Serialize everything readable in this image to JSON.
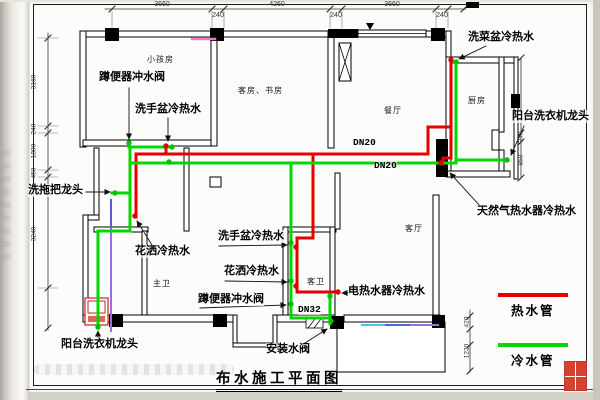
{
  "title": "布水施工平面图",
  "legend": [
    {
      "label": "热水管",
      "color": "#e60000"
    },
    {
      "label": "冷水管",
      "color": "#00d800"
    }
  ],
  "colors": {
    "hot": "#e60000",
    "cold": "#00d800",
    "wall": "#000000"
  },
  "rooms": [
    {
      "label": "小孩房",
      "x": 147,
      "y": 55
    },
    {
      "label": "客房、书房",
      "x": 238,
      "y": 86
    },
    {
      "label": "餐厅",
      "x": 384,
      "y": 106
    },
    {
      "label": "厨房",
      "x": 468,
      "y": 96
    },
    {
      "label": "客厅",
      "x": 405,
      "y": 224
    },
    {
      "label": "主卫",
      "x": 153,
      "y": 279
    },
    {
      "label": "客卫",
      "x": 307,
      "y": 277
    }
  ],
  "fixtures": [
    {
      "label": "蹲便器冲水阀",
      "x": 99,
      "y": 71
    },
    {
      "label": "洗手盆冷热水",
      "x": 135,
      "y": 103
    },
    {
      "label": "洗菜盆冷热水",
      "x": 468,
      "y": 31
    },
    {
      "label": "阳台洗衣机龙头",
      "x": 512,
      "y": 110
    },
    {
      "label": "洗拖把龙头",
      "x": 28,
      "y": 184
    },
    {
      "label": "天然气热水器冷热水",
      "x": 477,
      "y": 205
    },
    {
      "label": "洗手盆冷热水",
      "x": 218,
      "y": 230
    },
    {
      "label": "花洒冷热水",
      "x": 224,
      "y": 265
    },
    {
      "label": "蹲便器冲水阀",
      "x": 198,
      "y": 293
    },
    {
      "label": "电热水器冷热水",
      "x": 348,
      "y": 285
    },
    {
      "label": "花洒冷热水",
      "x": 135,
      "y": 245
    },
    {
      "label": "阳台洗衣机龙头",
      "x": 61,
      "y": 338
    },
    {
      "label": "安装水阀",
      "x": 266,
      "y": 343
    }
  ],
  "pipe_sizes": [
    {
      "label": "DN20",
      "x": 353,
      "y": 138
    },
    {
      "label": "DN20",
      "x": 374,
      "y": 161
    },
    {
      "label": "DN32",
      "x": 298,
      "y": 305
    }
  ],
  "dims_top": [
    {
      "label": "3660",
      "x": 162,
      "y": 1
    },
    {
      "label": "240",
      "x": 218,
      "y": 12
    },
    {
      "label": "4260",
      "x": 277,
      "y": 1
    },
    {
      "label": "240",
      "x": 336,
      "y": 12
    },
    {
      "label": "3660",
      "x": 392,
      "y": 1
    },
    {
      "label": "240",
      "x": 442,
      "y": 12
    }
  ],
  "dims_left": [
    {
      "label": "3160",
      "x": 34,
      "y": 82
    },
    {
      "label": "240",
      "x": 34,
      "y": 129
    },
    {
      "label": "1800",
      "x": 34,
      "y": 151
    },
    {
      "label": "450",
      "x": 34,
      "y": 173
    },
    {
      "label": "3240",
      "x": 34,
      "y": 234
    }
  ],
  "dims_right": [
    {
      "label": "240",
      "x": 521,
      "y": 137
    },
    {
      "label": "850",
      "x": 521,
      "y": 160
    },
    {
      "label": "420",
      "x": 467,
      "y": 322
    },
    {
      "label": "1220",
      "x": 467,
      "y": 351
    }
  ],
  "geometry": {
    "walls_hollow": [
      [
        80,
        31,
        370,
        6
      ],
      [
        80,
        31,
        6,
        116
      ],
      [
        83,
        140,
        133,
        6
      ],
      [
        211,
        31,
        6,
        115
      ],
      [
        328,
        31,
        6,
        117
      ],
      [
        446,
        31,
        5,
        32
      ],
      [
        446,
        57,
        72,
        6
      ],
      [
        446,
        57,
        5,
        116
      ],
      [
        499,
        57,
        5,
        75
      ],
      [
        499,
        150,
        5,
        27
      ],
      [
        446,
        171,
        64,
        6
      ],
      [
        514,
        57,
        4,
        122
      ],
      [
        433,
        195,
        6,
        125
      ],
      [
        94,
        148,
        5,
        71
      ],
      [
        184,
        148,
        5,
        83
      ],
      [
        83,
        215,
        16,
        5
      ],
      [
        83,
        215,
        5,
        106
      ],
      [
        94,
        227,
        54,
        5
      ],
      [
        142,
        231,
        5,
        89
      ],
      [
        283,
        227,
        53,
        5
      ],
      [
        283,
        227,
        5,
        92
      ],
      [
        330,
        227,
        5,
        92
      ],
      [
        335,
        173,
        5,
        56
      ],
      [
        83,
        315,
        150,
        7
      ],
      [
        233,
        315,
        4,
        32
      ],
      [
        233,
        343,
        44,
        4
      ],
      [
        273,
        315,
        4,
        32
      ],
      [
        277,
        315,
        58,
        7
      ],
      [
        344,
        315,
        96,
        7
      ],
      [
        337,
        322,
        108,
        50
      ],
      [
        358,
        30,
        68,
        7
      ],
      [
        492,
        130,
        7,
        20
      ],
      [
        210,
        177,
        11,
        10
      ]
    ],
    "walls_solid": [
      [
        105,
        28,
        14,
        13
      ],
      [
        210,
        28,
        14,
        13
      ],
      [
        328,
        29,
        30,
        9
      ],
      [
        431,
        28,
        14,
        13
      ],
      [
        511,
        94,
        9,
        14
      ],
      [
        436,
        139,
        12,
        38
      ],
      [
        466,
        2,
        13,
        6
      ],
      [
        109,
        314,
        14,
        13
      ],
      [
        213,
        314,
        14,
        13
      ],
      [
        330,
        316,
        14,
        13
      ],
      [
        432,
        315,
        13,
        13
      ]
    ],
    "window_mid": [
      358,
      33.5,
      426,
      33.5
    ],
    "xcol": [
      339,
      43,
      12,
      38
    ],
    "hatch_box": [
      306,
      319,
      17,
      9
    ],
    "tri_marker": [
      370,
      23
    ],
    "wm_outer": [
      85,
      298,
      23,
      27
    ],
    "wm_inner": [
      88,
      301,
      17,
      12
    ],
    "wm_strip": [
      88,
      316,
      17,
      6
    ],
    "pipes_hot": [
      [
        [
          166,
          146
        ],
        [
          166,
          154
        ]
      ],
      [
        [
          136,
          154
        ],
        [
          428,
          154
        ]
      ],
      [
        [
          136,
          154
        ],
        [
          136,
          217
        ]
      ],
      [
        [
          313,
          154
        ],
        [
          313,
          238
        ],
        [
          297,
          238
        ],
        [
          297,
          292
        ],
        [
          338,
          292
        ]
      ],
      [
        [
          428,
          154
        ],
        [
          428,
          127
        ],
        [
          451,
          127
        ]
      ],
      [
        [
          451,
          60
        ],
        [
          451,
          158
        ],
        [
          443,
          158
        ],
        [
          443,
          164
        ]
      ]
    ],
    "pipes_cold": [
      [
        [
          129,
          147
        ],
        [
          173,
          147
        ]
      ],
      [
        [
          130,
          147
        ],
        [
          130,
          193
        ]
      ],
      [
        [
          112,
          193
        ],
        [
          130,
          193
        ]
      ],
      [
        [
          130,
          193
        ],
        [
          130,
          231
        ],
        [
          98,
          231
        ],
        [
          98,
          328
        ]
      ],
      [
        [
          130,
          163
        ],
        [
          456,
          163
        ]
      ],
      [
        [
          456,
          62
        ],
        [
          456,
          163
        ]
      ],
      [
        [
          456,
          160
        ],
        [
          507,
          160
        ]
      ],
      [
        [
          291,
          163
        ],
        [
          291,
          318
        ],
        [
          330,
          318
        ]
      ],
      [
        [
          330,
          295
        ],
        [
          330,
          324
        ]
      ]
    ],
    "pipes_other": [
      {
        "c": "#f07ad0",
        "w": 2.5,
        "pts": [
          [
            192,
            39
          ],
          [
            215,
            39
          ]
        ]
      },
      {
        "c": "#5b5bd0",
        "w": 2,
        "pts": [
          [
            111,
            200
          ],
          [
            111,
            229
          ]
        ]
      },
      {
        "c": "#9a6fd8",
        "w": 2,
        "pts": [
          [
            111,
            229
          ],
          [
            111,
            331
          ]
        ]
      },
      {
        "c": "#45c8e8",
        "w": 2,
        "pts": [
          [
            362,
            325
          ],
          [
            386,
            325
          ]
        ]
      },
      {
        "c": "#4868e0",
        "w": 2,
        "pts": [
          [
            386,
            325
          ],
          [
            411,
            325
          ]
        ]
      },
      {
        "c": "#9a6fd8",
        "w": 2,
        "pts": [
          [
            411,
            325
          ],
          [
            438,
            325
          ]
        ]
      }
    ],
    "dots_cold": [
      [
        129,
        143
      ],
      [
        172,
        147
      ],
      [
        115,
        193
      ],
      [
        98,
        327
      ],
      [
        169,
        162
      ],
      [
        291,
        243
      ],
      [
        291,
        281
      ],
      [
        291,
        304
      ],
      [
        330,
        296
      ],
      [
        331,
        321
      ],
      [
        456,
        62
      ],
      [
        507,
        160
      ]
    ],
    "dots_hot": [
      [
        166,
        146
      ],
      [
        135,
        216
      ],
      [
        296,
        247
      ],
      [
        296,
        286
      ],
      [
        338,
        292
      ],
      [
        451,
        60
      ],
      [
        441,
        163
      ]
    ],
    "leaders": [
      [
        [
          129,
          88
        ],
        [
          129,
          139
        ]
      ],
      [
        [
          168,
          118
        ],
        [
          168,
          141
        ]
      ],
      [
        [
          486,
          46
        ],
        [
          459,
          59
        ]
      ],
      [
        [
          524,
          126
        ],
        [
          511,
          155
        ]
      ],
      [
        [
          86,
          192
        ],
        [
          110,
          192
        ]
      ],
      [
        [
          480,
          206
        ],
        [
          450,
          173
        ]
      ],
      [
        [
          219,
          246
        ],
        [
          287,
          245
        ]
      ],
      [
        [
          225,
          281
        ],
        [
          287,
          282
        ]
      ],
      [
        [
          200,
          308
        ],
        [
          286,
          305
        ]
      ],
      [
        [
          349,
          293
        ],
        [
          342,
          293
        ]
      ],
      [
        [
          152,
          245
        ],
        [
          137,
          221
        ]
      ],
      [
        [
          98,
          337
        ],
        [
          98,
          331
        ]
      ],
      [
        [
          305,
          343
        ],
        [
          327,
          329
        ]
      ]
    ],
    "dim_lines": [
      {
        "dir": "h",
        "y": 9,
        "x1": 105,
        "x2": 466,
        "ticks": [
          112,
          212,
          224,
          330,
          342,
          436,
          448,
          464
        ]
      },
      {
        "dir": "v",
        "x": 48,
        "y1": 33,
        "y2": 330,
        "ticks": [
          38,
          126,
          133,
          170,
          177,
          288,
          328
        ]
      },
      {
        "dir": "v",
        "x": 521,
        "y1": 58,
        "y2": 178,
        "ticks": [
          58,
          133,
          142,
          178
        ]
      },
      {
        "dir": "v",
        "x": 470,
        "y1": 310,
        "y2": 372,
        "ticks": [
          316,
          329,
          345,
          371
        ]
      }
    ],
    "ext_top": [
      112,
      212,
      224,
      330,
      342,
      436,
      448
    ],
    "ext_left": [
      38,
      126,
      133,
      170,
      177,
      288
    ]
  }
}
